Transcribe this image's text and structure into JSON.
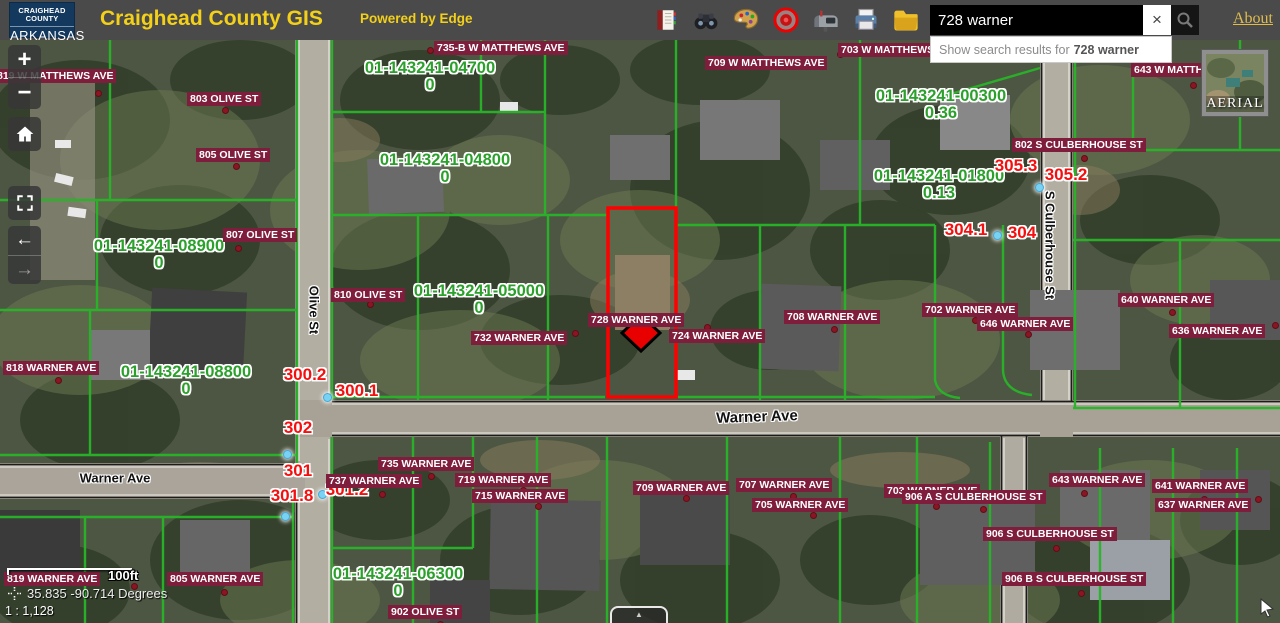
{
  "header": {
    "logo_line1": "CRAIGHEAD COUNTY",
    "logo_line2": "ARKANSAS",
    "title": "Craighead County GIS",
    "powered_by": "Powered by Edge",
    "about": "About",
    "search": {
      "value": "728 warner",
      "clear_label": "×"
    },
    "suggestion": {
      "prefix": "Show search results for",
      "term": "728 warner"
    },
    "toolbar_icons": [
      "book-icon",
      "binoculars-icon",
      "palette-icon",
      "target-icon",
      "mailbox-icon",
      "printer-icon",
      "folder-icon"
    ]
  },
  "nav": {
    "zoom_in": "+",
    "zoom_out": "−",
    "back": "←",
    "forward": "→",
    "expand_tab": "▲"
  },
  "basemap": {
    "label": "AERIAL"
  },
  "scale": {
    "bar_label": "100ft",
    "coordinates": "35.835 -90.714 Degrees",
    "ratio": "1 : 1,128"
  },
  "colors": {
    "accent_yellow": "#f3d019",
    "parcel_green": "#2ca02c",
    "address_maroon": "#7e1e3c",
    "selection_red": "#ff0000",
    "marker_blue": "#79d2f4"
  },
  "map": {
    "selected_parcel_address": "728 WARNER AVE",
    "address_labels": [
      {
        "text": "735-B W MATTHEWS AVE",
        "x": 434,
        "y": 1
      },
      {
        "text": "703 W MATTHEWS AVE",
        "x": 838,
        "y": 3
      },
      {
        "text": "709 W MATTHEWS AVE",
        "x": 705,
        "y": 16
      },
      {
        "text": "643 W MATTHEWS AVE",
        "x": 1131,
        "y": 23
      },
      {
        "text": "819 W MATTHEWS AVE",
        "x": -6,
        "y": 29
      },
      {
        "text": "803 OLIVE ST",
        "x": 187,
        "y": 52
      },
      {
        "text": "805 OLIVE ST",
        "x": 196,
        "y": 108
      },
      {
        "text": "807 OLIVE ST",
        "x": 223,
        "y": 188
      },
      {
        "text": "810 OLIVE ST",
        "x": 331,
        "y": 248
      },
      {
        "text": "802 S CULBERHOUSE ST",
        "x": 1012,
        "y": 98
      },
      {
        "text": "818 WARNER AVE",
        "x": 3,
        "y": 321
      },
      {
        "text": "732 WARNER AVE",
        "x": 471,
        "y": 291
      },
      {
        "text": "728 WARNER AVE",
        "x": 588,
        "y": 273
      },
      {
        "text": "724 WARNER AVE",
        "x": 669,
        "y": 289
      },
      {
        "text": "708 WARNER AVE",
        "x": 784,
        "y": 270
      },
      {
        "text": "702 WARNER AVE",
        "x": 922,
        "y": 263
      },
      {
        "text": "646 WARNER AVE",
        "x": 977,
        "y": 277
      },
      {
        "text": "640 WARNER AVE",
        "x": 1118,
        "y": 253
      },
      {
        "text": "636 WARNER AVE",
        "x": 1169,
        "y": 284
      },
      {
        "text": "735 WARNER AVE",
        "x": 378,
        "y": 417
      },
      {
        "text": "737 WARNER AVE",
        "x": 326,
        "y": 434
      },
      {
        "text": "719 WARNER AVE",
        "x": 455,
        "y": 433
      },
      {
        "text": "715 WARNER AVE",
        "x": 472,
        "y": 449
      },
      {
        "text": "709 WARNER AVE",
        "x": 633,
        "y": 441
      },
      {
        "text": "707 WARNER AVE",
        "x": 736,
        "y": 438
      },
      {
        "text": "705 WARNER AVE",
        "x": 752,
        "y": 458
      },
      {
        "text": "703 WARNER AVE",
        "x": 884,
        "y": 444
      },
      {
        "text": "906 A S CULBERHOUSE ST",
        "x": 902,
        "y": 450
      },
      {
        "text": "643 WARNER AVE",
        "x": 1049,
        "y": 433
      },
      {
        "text": "641 WARNER AVE",
        "x": 1152,
        "y": 439
      },
      {
        "text": "637 WARNER AVE",
        "x": 1155,
        "y": 458
      },
      {
        "text": "906 S CULBERHOUSE ST",
        "x": 983,
        "y": 487
      },
      {
        "text": "906 B S CULBERHOUSE ST",
        "x": 1002,
        "y": 532
      },
      {
        "text": "819 WARNER AVE",
        "x": 4,
        "y": 532
      },
      {
        "text": "805 WARNER AVE",
        "x": 167,
        "y": 532
      },
      {
        "text": "902 OLIVE ST",
        "x": 388,
        "y": 565
      }
    ],
    "parcel_labels": [
      {
        "id": "01-143241-04700",
        "area": "0",
        "x": 430,
        "y": 20
      },
      {
        "id": "01-143241-04800",
        "area": "0",
        "x": 445,
        "y": 112
      },
      {
        "id": "01-143241-00300",
        "area": "0.36",
        "x": 941,
        "y": 48
      },
      {
        "id": "01-143241-01800",
        "area": "0.13",
        "x": 939,
        "y": 128
      },
      {
        "id": "01-143241-08900",
        "area": "0",
        "x": 159,
        "y": 198
      },
      {
        "id": "01-143241-08800",
        "area": "0",
        "x": 186,
        "y": 324
      },
      {
        "id": "01-143241-05000",
        "area": "0",
        "x": 479,
        "y": 243
      },
      {
        "id": "01-143241-06300",
        "area": "0",
        "x": 398,
        "y": 526
      }
    ],
    "red_point_labels": [
      {
        "text": "300.2",
        "x": 305,
        "y": 335
      },
      {
        "text": "300.1",
        "x": 357,
        "y": 351
      },
      {
        "text": "302",
        "x": 298,
        "y": 388
      },
      {
        "text": "301",
        "x": 298,
        "y": 431
      },
      {
        "text": "301.8",
        "x": 292,
        "y": 456
      },
      {
        "text": "301.2",
        "x": 347,
        "y": 450
      },
      {
        "text": "304.1",
        "x": 966,
        "y": 190
      },
      {
        "text": "304",
        "x": 1022,
        "y": 193
      },
      {
        "text": "305.3",
        "x": 1016,
        "y": 126
      },
      {
        "text": "305.2",
        "x": 1066,
        "y": 135
      }
    ],
    "street_labels": [
      {
        "text": "Warner Ave",
        "x": 757,
        "y": 377,
        "rot": -2,
        "size": 15
      },
      {
        "text": "Warner Ave",
        "x": 115,
        "y": 438,
        "rot": 0,
        "size": 13
      },
      {
        "text": "Olive St",
        "x": 314,
        "y": 270,
        "rot": 90,
        "size": 13
      },
      {
        "text": "S Culberhouse St",
        "x": 1050,
        "y": 205,
        "rot": 90,
        "size": 13
      }
    ],
    "red_dots": [
      [
        427,
        7
      ],
      [
        837,
        11
      ],
      [
        1190,
        42
      ],
      [
        95,
        50
      ],
      [
        222,
        67
      ],
      [
        233,
        123
      ],
      [
        235,
        205
      ],
      [
        367,
        261
      ],
      [
        1081,
        115
      ],
      [
        55,
        337
      ],
      [
        572,
        290
      ],
      [
        704,
        284
      ],
      [
        831,
        286
      ],
      [
        972,
        277
      ],
      [
        1025,
        291
      ],
      [
        1169,
        269
      ],
      [
        1272,
        282
      ],
      [
        428,
        433
      ],
      [
        379,
        451
      ],
      [
        520,
        447
      ],
      [
        535,
        463
      ],
      [
        683,
        455
      ],
      [
        790,
        453
      ],
      [
        810,
        472
      ],
      [
        933,
        463
      ],
      [
        980,
        466
      ],
      [
        1081,
        450
      ],
      [
        1201,
        456
      ],
      [
        1255,
        456
      ],
      [
        1053,
        505
      ],
      [
        1078,
        550
      ],
      [
        131,
        543
      ],
      [
        221,
        549
      ],
      [
        437,
        581
      ]
    ],
    "blue_markers": [
      [
        323,
        353
      ],
      [
        283,
        410
      ],
      [
        318,
        450
      ],
      [
        281,
        472
      ],
      [
        1035,
        143
      ],
      [
        993,
        191
      ]
    ]
  }
}
